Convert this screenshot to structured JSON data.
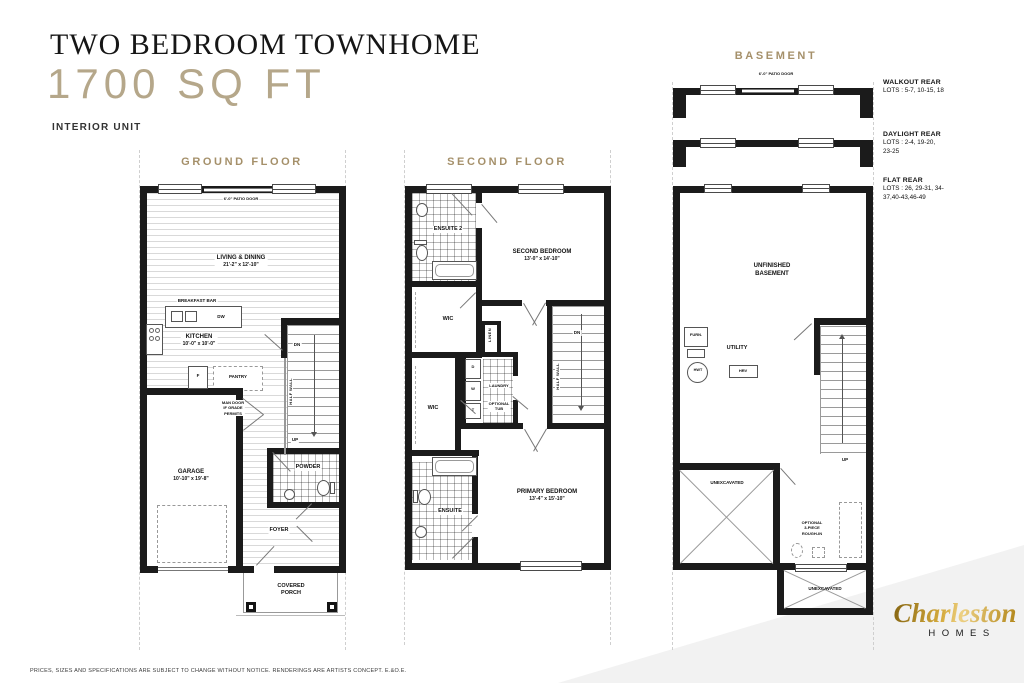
{
  "header": {
    "title": "TWO BEDROOM TOWNHOME",
    "sqft": "1700 SQ FT",
    "unit_type": "INTERIOR UNIT"
  },
  "ground_floor": {
    "heading": "GROUND FLOOR",
    "patio_door": "6'-0\" PATIO DOOR",
    "living_dining": {
      "name": "LIVING & DINING",
      "dims": "21'-2\" x 12'-10\""
    },
    "breakfast_bar": "BREAKFAST BAR",
    "dishwasher": "DW",
    "kitchen": {
      "name": "KITCHEN",
      "dims": "10'-0\" x 10'-0\""
    },
    "fridge": "F",
    "pantry": "PANTRY",
    "stairs_down": "DN",
    "stairs_up": "UP",
    "half_wall": "HALF WALL",
    "man_door": "MAN DOOR\nIF GRADE\nPERMITS",
    "garage": {
      "name": "GARAGE",
      "dims": "10'-10\" x 19'-8\""
    },
    "powder": "POWDER",
    "foyer": "FOYER",
    "covered_porch": "COVERED\nPORCH"
  },
  "second_floor": {
    "heading": "SECOND FLOOR",
    "ensuite2": "ENSUITE 2",
    "second_bedroom": {
      "name": "SECOND BEDROOM",
      "dims": "13'-0\" x 14'-10\""
    },
    "wic_second": "WIC",
    "linen": "LINEN",
    "stairs_down": "DN",
    "half_wall": "HALF WALL",
    "dryer": "D",
    "washer": "W",
    "tub": "T",
    "laundry": "LAUNDRY",
    "optional_tub": "OPTIONAL\nTUB",
    "wic_primary": "WIC",
    "ensuite": "ENSUITE",
    "primary_bedroom": {
      "name": "PRIMARY BEDROOM",
      "dims": "13'-4\" x 15'-10\""
    }
  },
  "basement": {
    "heading": "BASEMENT",
    "patio_door": "6'-0\" PATIO DOOR",
    "options": [
      {
        "name": "WALKOUT REAR",
        "lots": "LOTS : 5-7, 10-15, 18"
      },
      {
        "name": "DAYLIGHT REAR",
        "lots": "LOTS : 2-4, 19-20, 23-25"
      },
      {
        "name": "FLAT REAR",
        "lots": "LOTS : 26, 29-31, 34-37,40-43,46-49"
      }
    ],
    "unfinished_basement": "UNFINISHED\nBASEMENT",
    "furnace": "FURN.",
    "utility": "UTILITY",
    "hwt": "HWT",
    "hrv": "HRV",
    "stairs_up": "UP",
    "unexcavated_main": "UNEXCAVATED",
    "rough_in": "OPTIONAL\n3-PIECE\nROUGH-IN",
    "unexcavated_rear": "UNEXCAVATED"
  },
  "footer": {
    "disclaimer": "PRICES, SIZES AND SPECIFICATIONS ARE SUBJECT TO CHANGE WITHOUT NOTICE. RENDERINGS ARE ARTISTS CONCEPT. E.&O.E.",
    "logo": {
      "script": "Charleston",
      "sub": "HOMES"
    }
  },
  "colors": {
    "accent_tan": "#A5906A",
    "sqft_tan": "#B5A78A",
    "wall_black": "#1B1B1B",
    "corner_band": "#F2F2F2",
    "logo_gold": "#C49A3B"
  }
}
